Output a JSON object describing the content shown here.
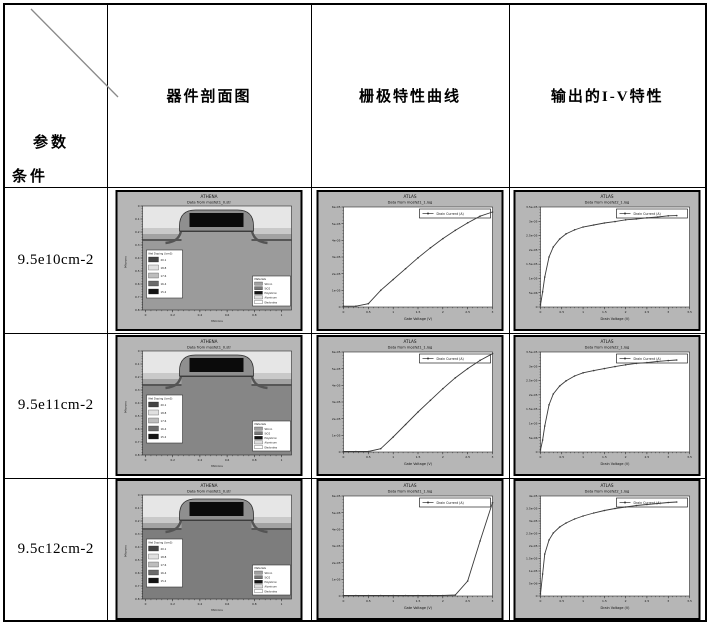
{
  "table": {
    "corner": {
      "top_label": "参数",
      "bottom_label": "条件"
    },
    "headers": [
      "器件剖面图",
      "栅极特性曲线",
      "输出的I-V特性"
    ],
    "rows": [
      {
        "label": "9.5e10cm-2"
      },
      {
        "label": "9.5e11cm-2"
      },
      {
        "label": "9.5c12cm-2"
      }
    ]
  },
  "colors": {
    "plot_bg": "#b6b6b6",
    "plot_area": "#ffffff",
    "curve": "#3a3a3a",
    "frame": "#000000",
    "sky": "#e6e6e6"
  },
  "chart_data": [
    {
      "id": "athena-row1",
      "type": "cross-section",
      "title": "ATHENA",
      "subtitle": "Data from mosfet1_0.str",
      "xlabel": "Microns",
      "ylabel": "Microns",
      "x_ticks": [
        "0",
        "0.2",
        "0.4",
        "0.6",
        "0.8",
        "1"
      ],
      "y_ticks": [
        "0",
        "0.1",
        "0.2",
        "0.3",
        "0.4",
        "0.5",
        "0.6",
        "0.7",
        "0.8"
      ],
      "substrate_color": "#9b9b9b",
      "channel_color": "#b6b6b6",
      "doping_legend": {
        "title": "Net Doping (/cm3)",
        "entries": [
          "20.1",
          "18.8",
          "17.6",
          "16.4",
          "15.2"
        ],
        "swatches": [
          "#444444",
          "#e0e0e0",
          "#bdbdbd",
          "#6b6b6b",
          "#141414"
        ]
      },
      "materials_legend": {
        "title": "Materials",
        "entries": [
          "Silicon",
          "SiO2",
          "Polysilicon",
          "Aluminum",
          "Electrodes"
        ],
        "swatches": [
          "#a0a0a0",
          "#777777",
          "#141414",
          "#dddddd",
          "#ffffff"
        ]
      }
    },
    {
      "id": "gate-row1",
      "type": "line",
      "title": "ATLAS",
      "subtitle": "Data from mosfet1_1.log",
      "xlabel": "Gate Voltage (V)",
      "legend": "Drain Current (A)",
      "xlim": [
        0,
        3
      ],
      "ylim": [
        0,
        6e-05
      ],
      "x_ticks": [
        "0",
        "0.5",
        "1",
        "1.5",
        "2",
        "2.5",
        "3"
      ],
      "y_ticks": [
        "0",
        "1e-05",
        "2e-05",
        "3e-05",
        "4e-05",
        "5e-05",
        "6e-05"
      ],
      "x": [
        0,
        0.25,
        0.5,
        0.75,
        1,
        1.25,
        1.5,
        1.75,
        2,
        2.25,
        2.5,
        2.75,
        3
      ],
      "y": [
        5e-07,
        5e-07,
        2e-06,
        1e-05,
        1.65e-05,
        2.3e-05,
        2.95e-05,
        3.55e-05,
        4.1e-05,
        4.6e-05,
        5.05e-05,
        5.45e-05,
        5.7e-05
      ]
    },
    {
      "id": "iv-row1",
      "type": "line",
      "title": "ATLAS",
      "subtitle": "Data from mosfet2_1.log",
      "xlabel": "Drain Voltage (V)",
      "legend": "Drain Current (A)",
      "xlim": [
        0,
        3.5
      ],
      "ylim": [
        0,
        3.5e-05
      ],
      "x_ticks": [
        "0",
        "0.5",
        "1",
        "1.5",
        "2",
        "2.5",
        "3",
        "3.5"
      ],
      "y_ticks": [
        "0",
        "5e-06",
        "1e-05",
        "1.5e-05",
        "2e-05",
        "2.5e-05",
        "3e-05",
        "3.5e-05"
      ],
      "x": [
        0,
        0.05,
        0.1,
        0.2,
        0.3,
        0.45,
        0.6,
        0.8,
        1,
        1.25,
        1.5,
        1.75,
        2,
        2.25,
        2.5,
        2.75,
        3,
        3.2
      ],
      "y": [
        7e-07,
        5.3e-06,
        1.05e-05,
        1.75e-05,
        2.1e-05,
        2.38e-05,
        2.56e-05,
        2.7e-05,
        2.8e-05,
        2.87e-05,
        2.94e-05,
        2.99e-05,
        3.05e-05,
        3.08e-05,
        3.12e-05,
        3.15e-05,
        3.19e-05,
        3.2e-05
      ]
    },
    {
      "id": "athena-row2",
      "type": "cross-section",
      "title": "ATHENA",
      "subtitle": "Data from mosfet1_0.str",
      "xlabel": "Microns",
      "ylabel": "Microns",
      "x_ticks": [
        "0",
        "0.2",
        "0.4",
        "0.6",
        "0.8",
        "1"
      ],
      "y_ticks": [
        "0",
        "0.1",
        "0.2",
        "0.3",
        "0.4",
        "0.5",
        "0.6",
        "0.7",
        "0.8"
      ],
      "substrate_color": "#868686",
      "channel_color": "#a2a2a2",
      "doping_legend": {
        "title": "Net Doping (/cm3)",
        "entries": [
          "20.1",
          "18.8",
          "17.6",
          "16.4",
          "15.2"
        ],
        "swatches": [
          "#444444",
          "#e0e0e0",
          "#bdbdbd",
          "#6b6b6b",
          "#141414"
        ]
      },
      "materials_legend": {
        "title": "Materials",
        "entries": [
          "Silicon",
          "SiO2",
          "Polysilicon",
          "Aluminum",
          "Electrodes"
        ],
        "swatches": [
          "#a0a0a0",
          "#777777",
          "#141414",
          "#dddddd",
          "#ffffff"
        ]
      }
    },
    {
      "id": "gate-row2",
      "type": "line",
      "title": "ATLAS",
      "subtitle": "Data from mosfet1_1.log",
      "xlabel": "Gate Voltage (V)",
      "legend": "Drain Current (A)",
      "xlim": [
        0,
        3
      ],
      "ylim": [
        0,
        6e-05
      ],
      "x_ticks": [
        "0",
        "0.5",
        "1",
        "1.5",
        "2",
        "2.5",
        "3"
      ],
      "y_ticks": [
        "0",
        "1e-05",
        "2e-05",
        "3e-05",
        "4e-05",
        "5e-05",
        "6e-05"
      ],
      "x": [
        0,
        0.25,
        0.5,
        0.75,
        1,
        1.25,
        1.5,
        1.75,
        2,
        2.25,
        2.5,
        2.75,
        3
      ],
      "y": [
        3e-07,
        3e-07,
        3e-07,
        2e-06,
        9e-06,
        1.65e-05,
        2.4e-05,
        3.1e-05,
        3.8e-05,
        4.45e-05,
        5e-05,
        5.5e-05,
        5.9e-05
      ]
    },
    {
      "id": "iv-row2",
      "type": "line",
      "title": "ATLAS",
      "subtitle": "Data from mosfet2_1.log",
      "xlabel": "Drain Voltage (V)",
      "legend": "Drain Current (A)",
      "xlim": [
        0,
        3.5
      ],
      "ylim": [
        0,
        3.5e-05
      ],
      "x_ticks": [
        "0",
        "0.5",
        "1",
        "1.5",
        "2",
        "2.5",
        "3",
        "3.5"
      ],
      "y_ticks": [
        "0",
        "5e-06",
        "1e-05",
        "1.5e-05",
        "2e-05",
        "2.5e-05",
        "3e-05",
        "3.5e-05"
      ],
      "x": [
        0,
        0.05,
        0.1,
        0.2,
        0.3,
        0.45,
        0.6,
        0.8,
        1,
        1.25,
        1.5,
        1.75,
        2,
        2.25,
        2.5,
        2.75,
        3,
        3.2
      ],
      "y": [
        7e-07,
        4.2e-06,
        9.1e-06,
        1.65e-05,
        2.03e-05,
        2.31e-05,
        2.49e-05,
        2.66e-05,
        2.77e-05,
        2.85e-05,
        2.92e-05,
        2.99e-05,
        3.05e-05,
        3.1e-05,
        3.13e-05,
        3.17e-05,
        3.2e-05,
        3.22e-05
      ]
    },
    {
      "id": "athena-row3",
      "type": "cross-section",
      "title": "ATHENA",
      "subtitle": "Data from mosfet1_0.str",
      "xlabel": "Microns",
      "ylabel": "Microns",
      "x_ticks": [
        "0",
        "0.2",
        "0.4",
        "0.6",
        "0.8",
        "1"
      ],
      "y_ticks": [
        "0",
        "0.1",
        "0.2",
        "0.3",
        "0.4",
        "0.5",
        "0.6",
        "0.7",
        "0.8"
      ],
      "substrate_color": "#7d7d7d",
      "channel_color": "#c6c6c6",
      "doping_legend": {
        "title": "Net Doping (/cm3)",
        "entries": [
          "20.1",
          "18.8",
          "17.6",
          "16.4",
          "15.2"
        ],
        "swatches": [
          "#444444",
          "#e0e0e0",
          "#bdbdbd",
          "#6b6b6b",
          "#141414"
        ]
      },
      "materials_legend": {
        "title": "Materials",
        "entries": [
          "Silicon",
          "SiO2",
          "Polysilicon",
          "Aluminum",
          "Electrodes"
        ],
        "swatches": [
          "#a0a0a0",
          "#777777",
          "#141414",
          "#dddddd",
          "#ffffff"
        ]
      }
    },
    {
      "id": "gate-row3",
      "type": "line",
      "title": "ATLAS",
      "subtitle": "Data from mosfet1_1.log",
      "xlabel": "Gate Voltage (V)",
      "legend": "Drain Current (A)",
      "xlim": [
        0,
        3
      ],
      "ylim": [
        0,
        6e-05
      ],
      "x_ticks": [
        "0",
        "0.5",
        "1",
        "1.5",
        "2",
        "2.5",
        "3"
      ],
      "y_ticks": [
        "0",
        "1e-05",
        "2e-05",
        "3e-05",
        "4e-05",
        "5e-05",
        "6e-05"
      ],
      "x": [
        0,
        0.25,
        0.5,
        0.75,
        1,
        1.25,
        1.5,
        1.75,
        2,
        2.25,
        2.5,
        2.75,
        3
      ],
      "y": [
        3e-07,
        3e-07,
        3e-07,
        3e-07,
        3e-07,
        3e-07,
        3e-07,
        3e-07,
        3e-07,
        6e-07,
        9e-06,
        3.3e-05,
        5.6e-05
      ]
    },
    {
      "id": "iv-row3",
      "type": "line",
      "title": "ATLAS",
      "subtitle": "Data from mosfet2_1.log",
      "xlabel": "Drain Voltage (V)",
      "legend": "Drain Current (A)",
      "xlim": [
        0,
        3.5
      ],
      "ylim": [
        0,
        4e-05
      ],
      "x_ticks": [
        "0",
        "0.5",
        "1",
        "1.5",
        "2",
        "2.5",
        "3",
        "3.5"
      ],
      "y_ticks": [
        "0",
        "5e-06",
        "1e-05",
        "1.5e-05",
        "2e-05",
        "2.5e-05",
        "3e-05",
        "3.5e-05",
        "4e-05"
      ],
      "x": [
        0,
        0.05,
        0.1,
        0.2,
        0.3,
        0.45,
        0.6,
        0.8,
        1,
        1.25,
        1.5,
        1.75,
        2,
        2.25,
        2.5,
        2.75,
        3,
        3.2
      ],
      "y": [
        8e-07,
        8.8e-06,
        1.68e-05,
        2.24e-05,
        2.52e-05,
        2.76e-05,
        2.92e-05,
        3.08e-05,
        3.2e-05,
        3.32e-05,
        3.42e-05,
        3.5e-05,
        3.56e-05,
        3.62e-05,
        3.66e-05,
        3.7e-05,
        3.74e-05,
        3.76e-05
      ]
    }
  ]
}
